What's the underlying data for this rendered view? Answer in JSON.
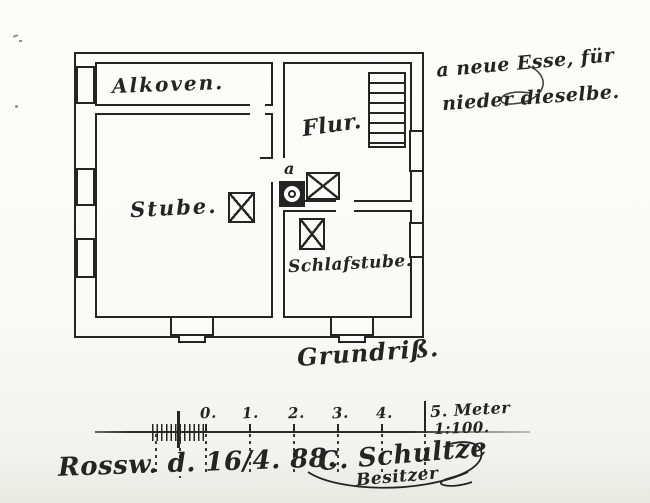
{
  "plan": {
    "caption": "Grundriß.",
    "rooms": {
      "alkoven": "Alkoven.",
      "stube": "Stube.",
      "flur": "Flur.",
      "schlafstube": "Schlafstube."
    },
    "marker": "a"
  },
  "annotation": {
    "line1": "a neue Esse, für",
    "line2": "nieder dieselbe."
  },
  "scale": {
    "numbers": [
      "0.",
      "1.",
      "2.",
      "3.",
      "4."
    ],
    "end_label": "5. Meter",
    "ratio": "1:100."
  },
  "footer": {
    "place_date": "Rossw. d. 16/4. 88.",
    "signature": "C. Schultze",
    "signature_role": "Besitzer"
  },
  "colors": {
    "ink": "#242424",
    "paper": "#fbfbf8"
  }
}
